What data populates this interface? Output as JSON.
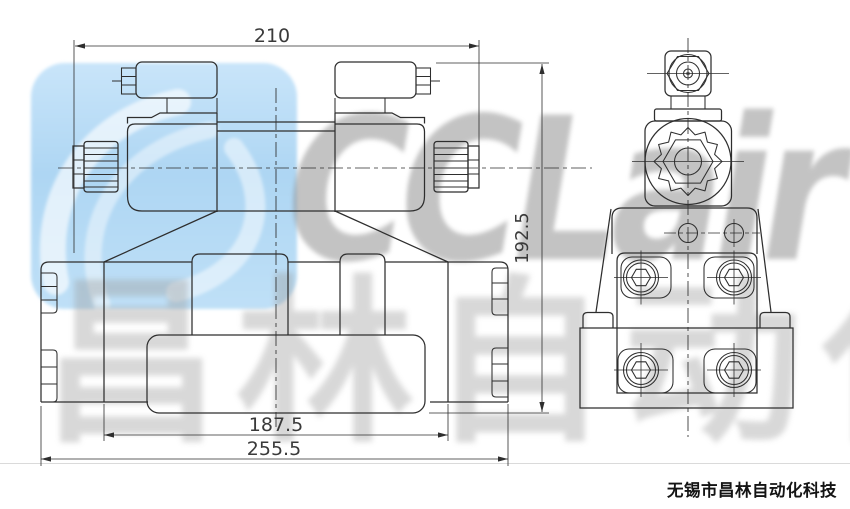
{
  "drawing": {
    "dim_width_top": "210",
    "dim_height": "192.5",
    "dim_width_inner": "187.5",
    "dim_width_total": "255.5"
  },
  "watermark": {
    "brand": "CCLair",
    "brand_cn": "昌林自动化"
  },
  "footer": {
    "company": "无锡市昌林自动化科技"
  },
  "colors": {
    "background": "#ffffff",
    "line": "#2e2e2e",
    "dim_text": "#3a3a3a",
    "logo_blue": "#b3d9f4",
    "watermark_gray": "#8d8d8d",
    "footer_text": "#141414"
  }
}
